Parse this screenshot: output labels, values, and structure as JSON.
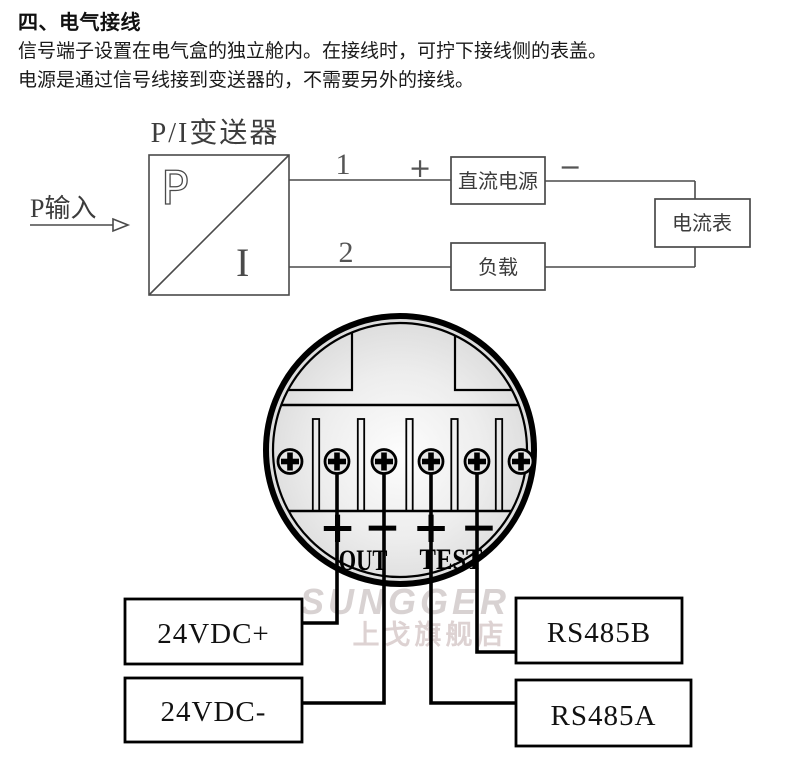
{
  "page": {
    "heading": "四、电气接线",
    "paragraph_line1": "信号端子设置在电气盒的独立舱内。在接线时，可拧下接线侧的表盖。",
    "paragraph_line2": "电源是通过信号线接到变送器的，不需要另外的接线。"
  },
  "circuit": {
    "title": "P/I变送器",
    "input_label": "P输入",
    "symbol_pressure": "P",
    "symbol_current": "I",
    "terminal1_label": "1",
    "terminal2_label": "2",
    "plus_sign": "+",
    "minus_sign": "−",
    "dc_power_label": "直流电源",
    "load_label": "负载",
    "ammeter_label": "电流表"
  },
  "terminal_block": {
    "out_label": "OUT",
    "test_label": "TEST",
    "signs": {
      "out_plus": "+",
      "out_minus": "−",
      "test_plus": "+",
      "test_minus": "−"
    },
    "wire_labels": [
      {
        "label": "24VDC+"
      },
      {
        "label": "24VDC-"
      },
      {
        "label": "RS485B"
      },
      {
        "label": "RS485A"
      }
    ]
  },
  "watermark": {
    "brand": "SUNGGER",
    "store": "上戈旗舰店"
  },
  "colors": {
    "thin_line": "#4a4a4a",
    "thick_line": "#000000",
    "face_gray": "#c9c9c9",
    "watermark_gray": "#d8d2d2"
  }
}
